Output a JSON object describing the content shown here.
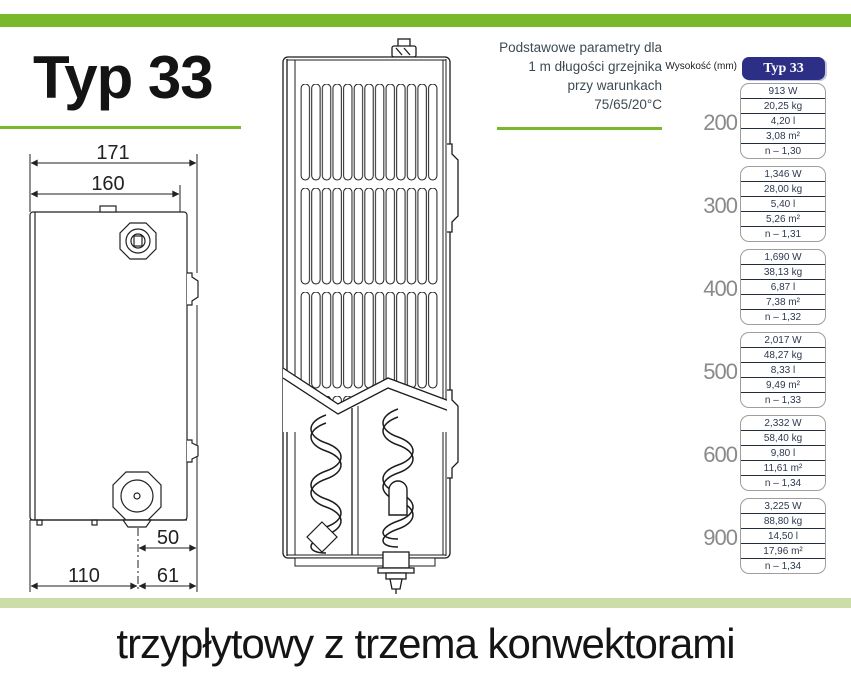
{
  "page": {
    "title": "Typ 33",
    "caption": "trzypłytowy z trzema konwektorami"
  },
  "params_note": {
    "lines": [
      "Podstawowe parametry dla",
      "1 m długości grzejnika",
      "przy warunkach",
      "75/65/20°C"
    ]
  },
  "table": {
    "height_label": "Wysokość (mm)",
    "column_header": "Typ 33",
    "groups": [
      {
        "height": "200",
        "values": [
          "913 W",
          "20,25 kg",
          "4,20 l",
          "3,08 m²",
          "n – 1,30"
        ]
      },
      {
        "height": "300",
        "values": [
          "1,346 W",
          "28,00 kg",
          "5,40 l",
          "5,26 m²",
          "n – 1,31"
        ]
      },
      {
        "height": "400",
        "values": [
          "1,690 W",
          "38,13 kg",
          "6,87 l",
          "7,38 m²",
          "n – 1,32"
        ]
      },
      {
        "height": "500",
        "values": [
          "2,017 W",
          "48,27 kg",
          "8,33 l",
          "9,49 m²",
          "n – 1,33"
        ]
      },
      {
        "height": "600",
        "values": [
          "2,332 W",
          "58,40 kg",
          "9,80 l",
          "11,61 m²",
          "n – 1,34"
        ]
      },
      {
        "height": "900",
        "values": [
          "3,225 W",
          "88,80 kg",
          "14,50 l",
          "17,96 m²",
          "n – 1,34"
        ]
      }
    ]
  },
  "drawing_dimensions": {
    "total_depth": "171",
    "panel_depth": "160",
    "valve_offset": "50",
    "left_spacing": "110",
    "right_spacing": "61"
  },
  "colors": {
    "accent_green": "#79b72b",
    "light_green_band": "#cddda7",
    "navy_header": "#2c2f85",
    "value_text": "#2c3850",
    "height_text": "#8a8a8a"
  }
}
